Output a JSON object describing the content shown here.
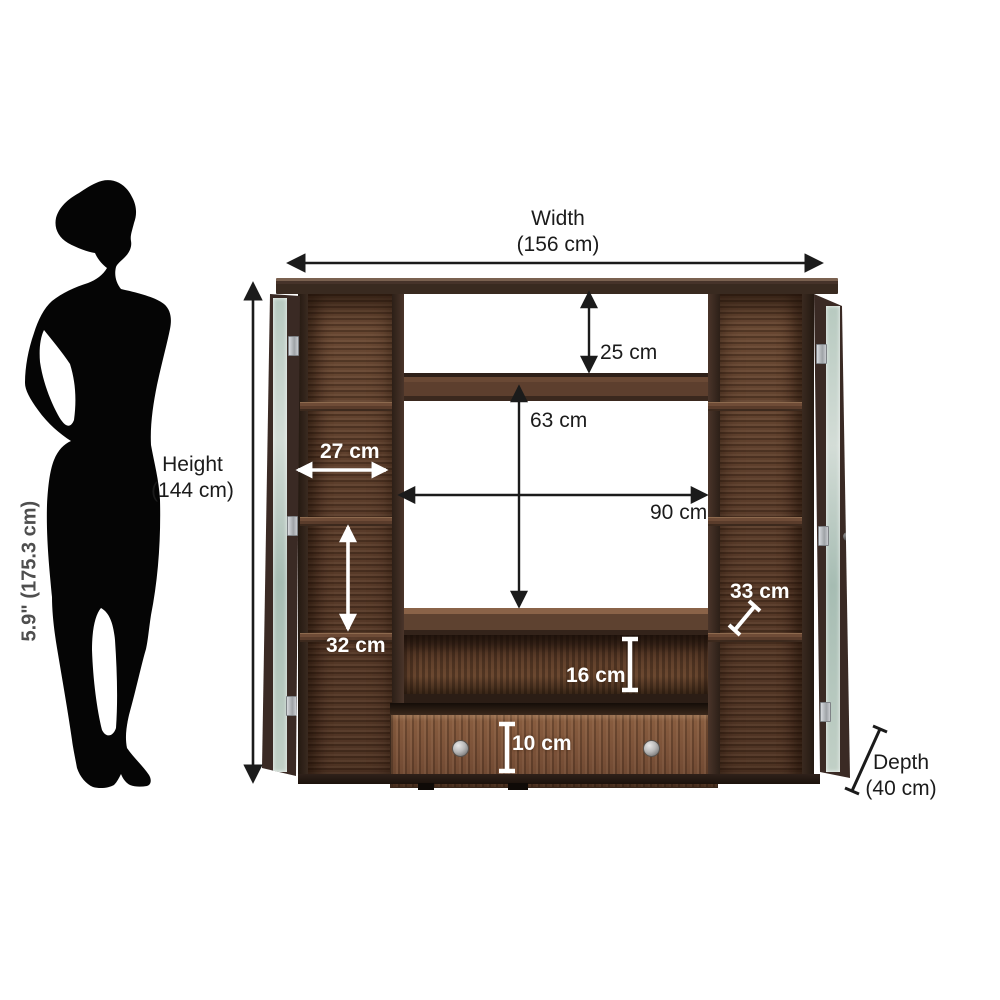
{
  "scale_figure": {
    "label": "5.9\" (175.3 cm)"
  },
  "dimensions": {
    "width": {
      "line1": "Width",
      "line2": "(156 cm)"
    },
    "height": {
      "line1": "Height",
      "line2": "(144 cm)"
    },
    "depth": {
      "line1": "Depth",
      "line2": "(40 cm)"
    },
    "top_shelf_height": "25 cm",
    "tv_opening_height": "63 cm",
    "tv_opening_width": "90 cm",
    "side_shelf_width": "27 cm",
    "side_shelf_height": "32 cm",
    "shelf_depth": "33 cm",
    "open_shelf_height": "16 cm",
    "drawer_height": "10 cm"
  },
  "colors": {
    "wood_dark": "#3c2b20",
    "wood_medium": "#5e4130",
    "wood_drawer": "#7d563c",
    "annotation_black": "#1b1b1b",
    "annotation_white": "#ffffff",
    "scale_text_gray": "#4e4e4e",
    "silhouette_black": "#050505",
    "background": "#ffffff"
  }
}
